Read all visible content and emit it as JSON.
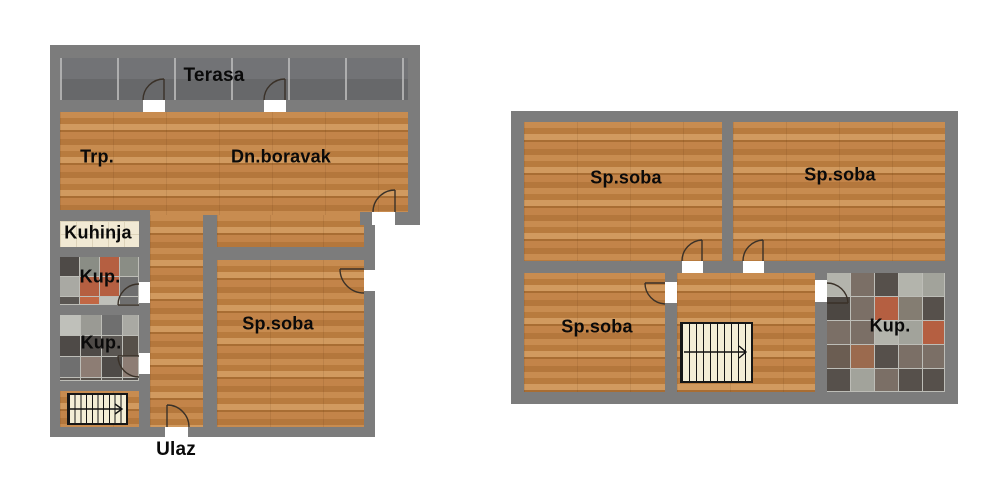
{
  "colors": {
    "wall": "#7c7c7c",
    "wood_base": "#c08347",
    "terrace_tile": "#6d6e70",
    "kitchen_tile": "#f1e9d4",
    "stairs_bg": "#f4eed6",
    "door_gap": "#ffffff",
    "arc_stroke": "#3a3128",
    "label": "#0a0a0a",
    "bath_palette": [
      "#8a8d85",
      "#6f6f6f",
      "#bfc0ba",
      "#5a5652",
      "#7a6a60",
      "#b55f41",
      "#c26744",
      "#8d7d74",
      "#4e4a47",
      "#a9a9a3",
      "#9a9a94",
      "#565049"
    ],
    "stone_palette": [
      "#a2a39b",
      "#8d9088",
      "#56504b",
      "#6b5d52",
      "#b55f41",
      "#4c4742",
      "#b3b4ac",
      "#7b6f66",
      "#9b6a4e",
      "#847d72"
    ]
  },
  "floor_plans": {
    "lower": {
      "labels": {
        "terasa": "Terasa",
        "trp": "Trp.",
        "dn_boravak": "Dn.boravak",
        "kuhinja": "Kuhinja",
        "kup1": "Kup.",
        "kup2": "Kup.",
        "sp_soba": "Sp.soba",
        "ulaz": "Ulaz"
      }
    },
    "upper": {
      "labels": {
        "sp_soba_1": "Sp.soba",
        "sp_soba_2": "Sp.soba",
        "sp_soba_3": "Sp.soba",
        "kup": "Kup."
      }
    }
  }
}
